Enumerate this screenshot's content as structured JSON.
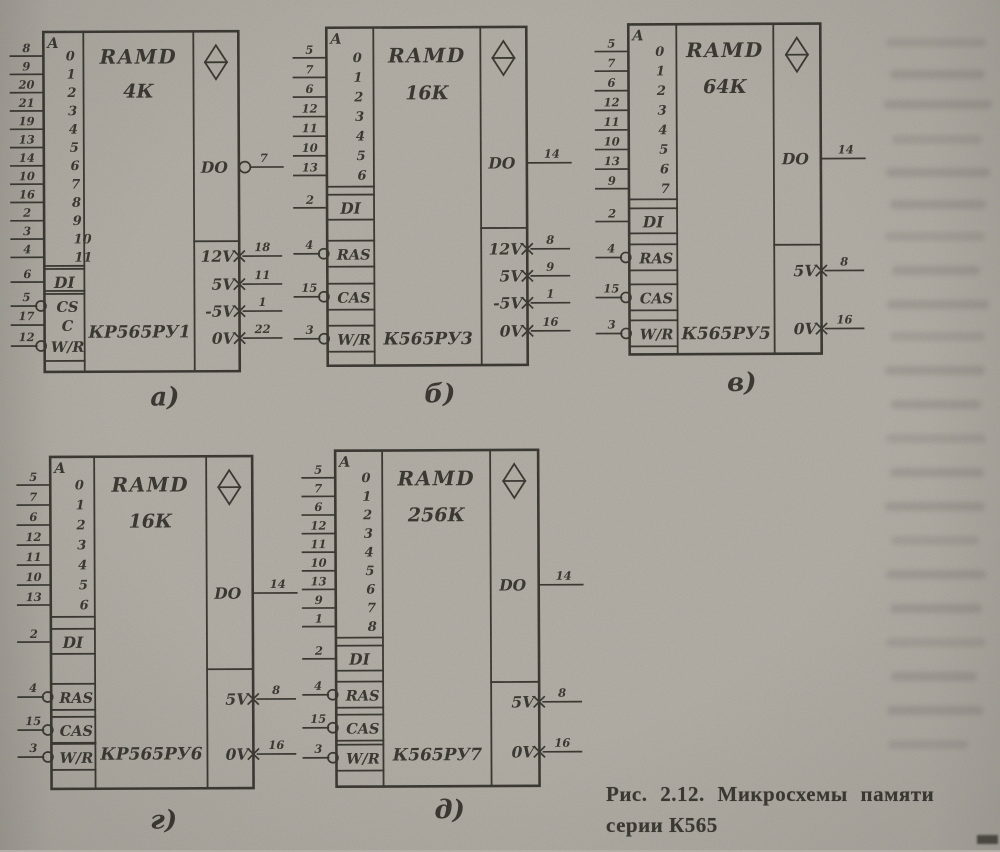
{
  "colors": {
    "ink": "#35322b",
    "paper": "#b4b0a8"
  },
  "caption": {
    "line1": "Рис. 2.12. Микросхемы памяти",
    "line2": "серии К565"
  },
  "chips": [
    {
      "label": "а)",
      "title": "RAMD",
      "capacity": "4К",
      "part": "КР565РУ1",
      "address_header": "A",
      "address_digits": [
        "0",
        "1",
        "2",
        "3",
        "4",
        "5",
        "6",
        "7",
        "8",
        "9",
        "10",
        "11"
      ],
      "address_pins": [
        "8",
        "9",
        "20",
        "21",
        "19",
        "13",
        "14",
        "10",
        "16",
        "2",
        "3",
        "4"
      ],
      "data_in": {
        "label": "DI",
        "pin": "6"
      },
      "controls": [
        {
          "label": "CS",
          "pin": "5",
          "circle": true
        },
        {
          "label": "C",
          "pin": "17",
          "circle": false
        },
        {
          "label": "W/R",
          "pin": "12",
          "circle": true
        }
      ],
      "data_out": {
        "label": "DO",
        "pin": "7",
        "circle": true
      },
      "power": [
        {
          "label": "12V",
          "pin": "18"
        },
        {
          "label": "5V",
          "pin": "11"
        },
        {
          "label": "-5V",
          "pin": "1"
        },
        {
          "label": "0V",
          "pin": "22"
        }
      ]
    },
    {
      "label": "б)",
      "title": "RAMD",
      "capacity": "16К",
      "part": "К565РУ3",
      "address_header": "A",
      "address_digits": [
        "0",
        "1",
        "2",
        "3",
        "4",
        "5",
        "6"
      ],
      "address_pins": [
        "5",
        "7",
        "6",
        "12",
        "11",
        "10",
        "13"
      ],
      "data_in": {
        "label": "DI",
        "pin": "2"
      },
      "controls": [
        {
          "label": "RAS",
          "pin": "4",
          "circle": true
        },
        {
          "label": "CAS",
          "pin": "15",
          "circle": true
        },
        {
          "label": "W/R",
          "pin": "3",
          "circle": true
        }
      ],
      "data_out": {
        "label": "DO",
        "pin": "14",
        "circle": false
      },
      "power": [
        {
          "label": "12V",
          "pin": "8"
        },
        {
          "label": "5V",
          "pin": "9"
        },
        {
          "label": "-5V",
          "pin": "1"
        },
        {
          "label": "0V",
          "pin": "16"
        }
      ]
    },
    {
      "label": "в)",
      "title": "RAMD",
      "capacity": "64К",
      "part": "К565РУ5",
      "address_header": "A",
      "address_digits": [
        "0",
        "1",
        "2",
        "3",
        "4",
        "5",
        "6",
        "7"
      ],
      "address_pins": [
        "5",
        "7",
        "6",
        "12",
        "11",
        "10",
        "13",
        "9"
      ],
      "data_in": {
        "label": "DI",
        "pin": "2"
      },
      "controls": [
        {
          "label": "RAS",
          "pin": "4",
          "circle": true
        },
        {
          "label": "CAS",
          "pin": "15",
          "circle": true
        },
        {
          "label": "W/R",
          "pin": "3",
          "circle": true
        }
      ],
      "data_out": {
        "label": "DO",
        "pin": "14",
        "circle": false
      },
      "power": [
        {
          "label": "5V",
          "pin": "8"
        },
        {
          "label": "0V",
          "pin": "16"
        }
      ]
    },
    {
      "label": "г)",
      "title": "RAMD",
      "capacity": "16К",
      "part": "КР565РУ6",
      "address_header": "A",
      "address_digits": [
        "0",
        "1",
        "2",
        "3",
        "4",
        "5",
        "6"
      ],
      "address_pins": [
        "5",
        "7",
        "6",
        "12",
        "11",
        "10",
        "13"
      ],
      "data_in": {
        "label": "DI",
        "pin": "2"
      },
      "controls": [
        {
          "label": "RAS",
          "pin": "4",
          "circle": true
        },
        {
          "label": "CAS",
          "pin": "15",
          "circle": true
        },
        {
          "label": "W/R",
          "pin": "3",
          "circle": true
        }
      ],
      "data_out": {
        "label": "DO",
        "pin": "14",
        "circle": false
      },
      "power": [
        {
          "label": "5V",
          "pin": "8"
        },
        {
          "label": "0V",
          "pin": "16"
        }
      ]
    },
    {
      "label": "д)",
      "title": "RAMD",
      "capacity": "256К",
      "part": "К565РУ7",
      "address_header": "A",
      "address_digits": [
        "0",
        "1",
        "2",
        "3",
        "4",
        "5",
        "6",
        "7",
        "8"
      ],
      "address_pins": [
        "5",
        "7",
        "6",
        "12",
        "11",
        "10",
        "13",
        "9",
        "1"
      ],
      "data_in": {
        "label": "DI",
        "pin": "2"
      },
      "controls": [
        {
          "label": "RAS",
          "pin": "4",
          "circle": true
        },
        {
          "label": "CAS",
          "pin": "15",
          "circle": true
        },
        {
          "label": "W/R",
          "pin": "3",
          "circle": true
        }
      ],
      "data_out": {
        "label": "DO",
        "pin": "14",
        "circle": false
      },
      "power": [
        {
          "label": "5V",
          "pin": "8"
        },
        {
          "label": "0V",
          "pin": "16"
        }
      ]
    }
  ]
}
